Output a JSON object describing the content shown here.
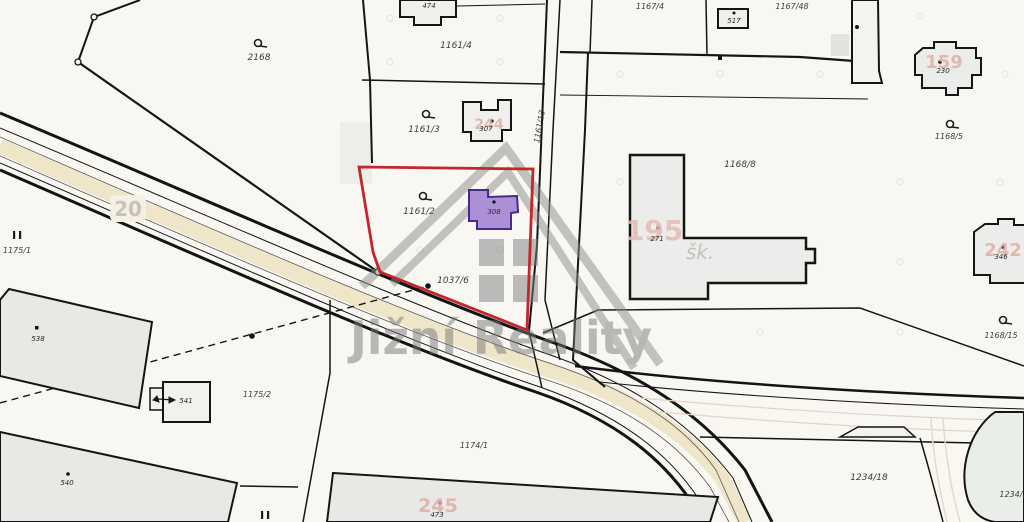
{
  "map": {
    "watermark_brand": "Jižní Reality",
    "road_shield": "20"
  },
  "colors": {
    "background": "#f8f7f2",
    "boundary_black": "#151515",
    "boundary_red": "#c3272b",
    "building_gray": "#e9e8e5",
    "building_light": "#efefec",
    "building_purple_fill": "#ab90d8",
    "building_purple_stroke": "#4a2a87",
    "road_beige": "#efe5c9",
    "road_faint": "#e0d4c6",
    "house_number_red": "#ddafa6",
    "watermark_gray": "#8c8c8c",
    "green_area": "#e9efe8"
  },
  "parcels": {
    "p2168": "2168",
    "p1161_2": "1161/2",
    "p1161_3": "1161/3",
    "p1161_4": "1161/4",
    "p1161_13": "1161/13",
    "p1167_4": "1167/4",
    "p1167_48": "1167/48",
    "p1168_5": "1168/5",
    "p1168_8": "1168/8",
    "p1168_15": "1168/15",
    "p1037_6": "1037/6",
    "p1175_1": "1175/1",
    "p1175_2": "1175/2",
    "p1174_1": "1174/1",
    "p1234_18": "1234/18",
    "p1234_16": "1234/16"
  },
  "buildings": {
    "b474": "474",
    "b517": "517",
    "b307": {
      "house_no": "244",
      "building_no": "307"
    },
    "b308": "308",
    "b230": {
      "house_no": "159",
      "building_no": "230"
    },
    "school": {
      "house_no": "195",
      "building_no": "271",
      "use_label": "šk."
    },
    "b346": {
      "house_no": "242",
      "building_no": "346"
    },
    "b473": {
      "house_no": "245",
      "building_no": "473"
    },
    "b538": "538",
    "b540": "540",
    "b541": "541"
  }
}
